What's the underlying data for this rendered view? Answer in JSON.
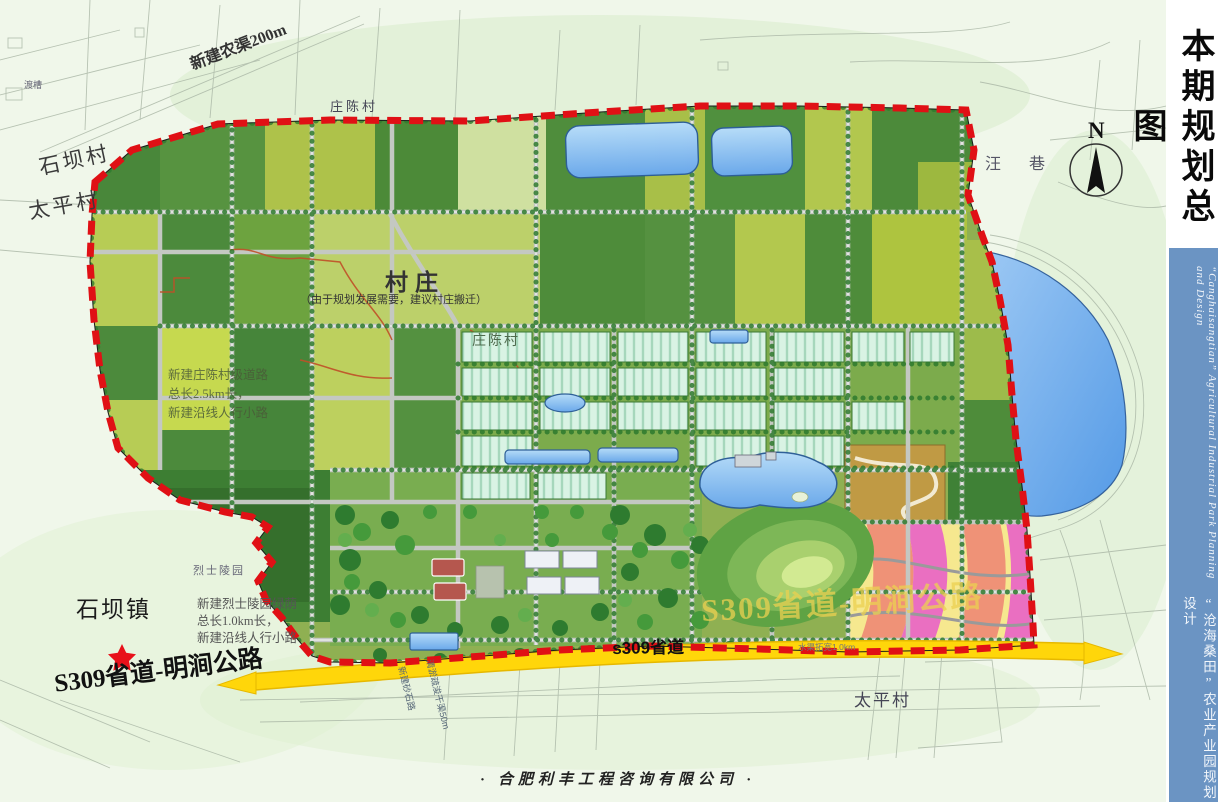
{
  "sidebar": {
    "title": "本期规划总图",
    "subtitle_cn": "“沧海桑田”农业产业园规划设计",
    "subtitle_en": "“Canghaisangtian” Agricultural Industrial Park Planning and Design",
    "panel_color": "#6b94c3"
  },
  "footer": {
    "company": "·  合肥利丰工程咨询有限公司  ·"
  },
  "map": {
    "colors": {
      "boundary_red": "#e01015",
      "highway_yellow": "#ffd60a",
      "water_blue": "#7fb7ee",
      "field_dark_green": "#4c8a3a",
      "field_yellow_green": "#b3c84e"
    },
    "compass": {
      "label": "N"
    },
    "labels": {
      "village_top_left": "石坝村",
      "village_top_left2": "太平村",
      "canal_note": "新建农渠200m",
      "aqueduct": "渡槽",
      "zhuangchen_top": "庄陈村",
      "village_block": "村庄",
      "village_block_note": "（由于规划发展需要，建议村庄搬迁）",
      "zhuangchen_mid": "庄陈村",
      "wangxiang": "汪  巷",
      "mid_note_1": "新建庄陈村级道路",
      "mid_note_2": "总长2.5km长，",
      "mid_note_3": "新建沿线人行小路",
      "martyr_park": "烈士陵园",
      "bottom_note_1": "新建烈士陵园绿荫",
      "bottom_note_2": "总长1.0km长，",
      "bottom_note_3": "新建沿线人行小路",
      "town": "石坝镇",
      "s309_full_left": "S309省道-明涧公路",
      "s309_on_road": "s309省道",
      "s309_watermark": "S309省道-明涧公路",
      "taiping_bottom": "太平村",
      "road_small_note": "水渠拓宽1.0km",
      "vert_note_1": "新建砂石路",
      "vert_note_2": "清淤疏浚干渠50m"
    }
  }
}
